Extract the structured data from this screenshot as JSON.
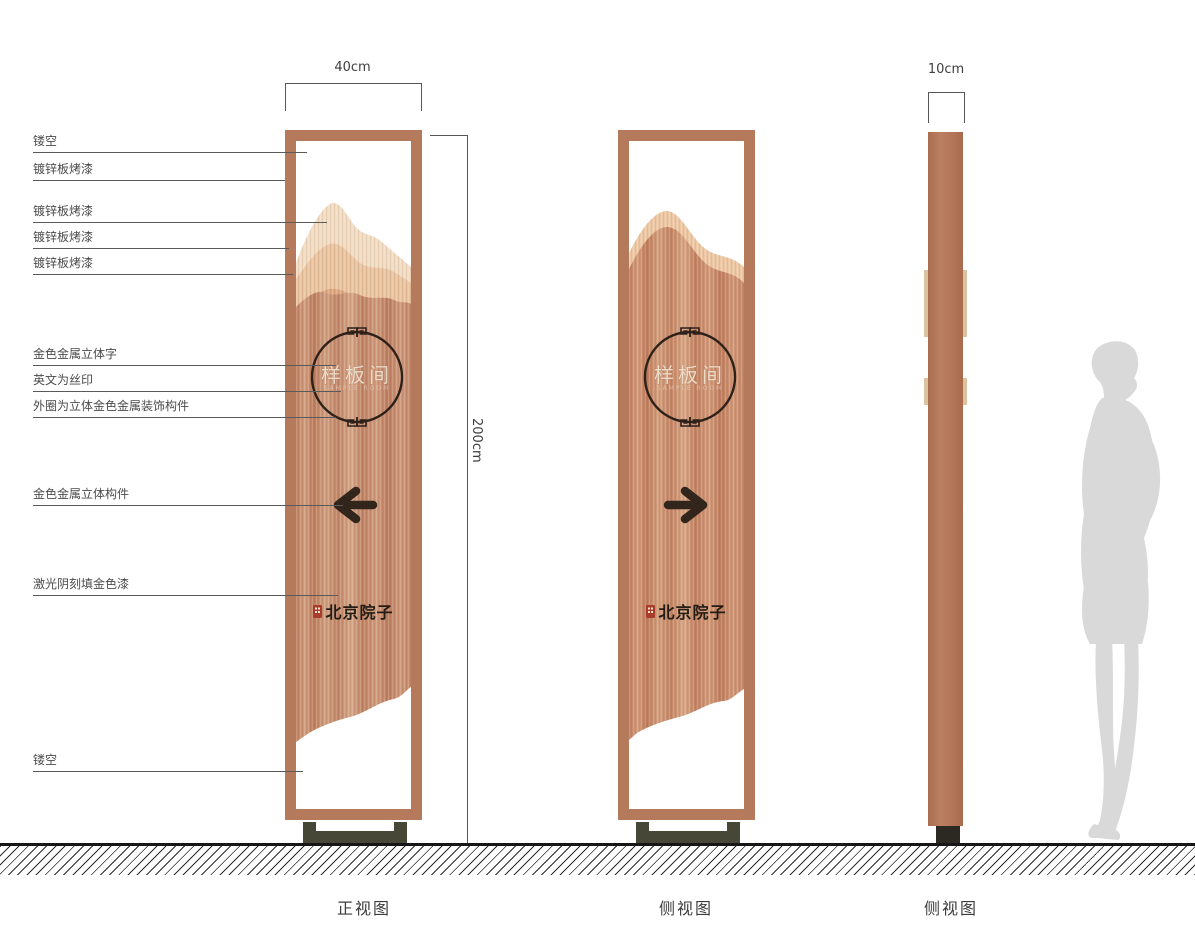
{
  "annotations": {
    "items": [
      {
        "text": "镂空"
      },
      {
        "text": "镀锌板烤漆"
      },
      {
        "text": "镀锌板烤漆"
      },
      {
        "text": "镀锌板烤漆"
      },
      {
        "text": "镀锌板烤漆"
      },
      {
        "text": "金色金属立体字"
      },
      {
        "text": "英文为丝印"
      },
      {
        "text": "外圈为立体金色金属装饰构件"
      },
      {
        "text": "金色金属立体构件"
      },
      {
        "text": "激光阴刻填金色漆"
      },
      {
        "text": "镂空"
      }
    ]
  },
  "dimensions": {
    "front_width": "40cm",
    "total_height": "200cm",
    "side_width": "10cm"
  },
  "panel": {
    "room_name": "样板间",
    "room_name_en": "SAMPLE ROOM",
    "brand": "北京院子"
  },
  "captions": {
    "front_view": "正视图",
    "side_view_1": "侧视图",
    "side_view_2": "侧视图"
  },
  "icons": {
    "arrow_left": "left-arrow",
    "arrow_right": "right-arrow",
    "seal": "red-seal-stamp",
    "circle_ornament": "fretwork-ring"
  },
  "colors": {
    "frame_copper": "#b5795c",
    "panel_copper": "#c88e6d",
    "mountain_light": "#f3dcc2",
    "mountain_mid": "#ecc5a0",
    "mountain_deep": "#dfa87f",
    "detail_dark": "#32251b",
    "base_olive": "#474738",
    "seal_red": "#a93b2b",
    "silhouette_gray": "#d9d9d9"
  }
}
